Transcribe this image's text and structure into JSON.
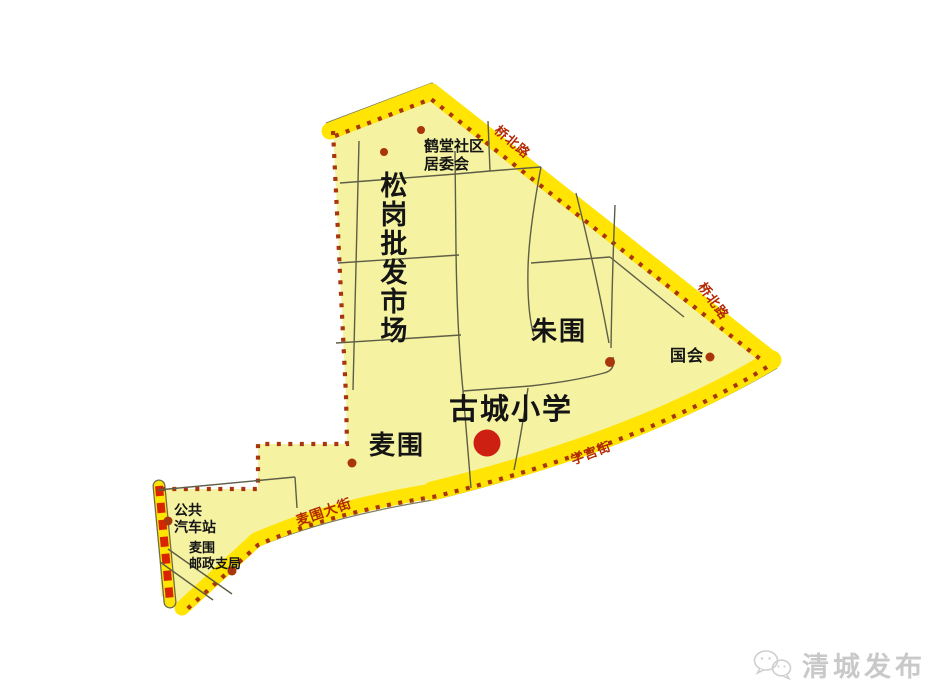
{
  "map": {
    "area_labels": {
      "songgang_market": "松岗批发市场",
      "zhuwei": "朱围",
      "maiwei": "麦围"
    },
    "poi_labels": {
      "hetang_committee": "鹤堂社区\n居委会",
      "guohui": "国会",
      "gucheng_school": "古城小学",
      "bus_station": "公共\n汽车站",
      "maiwei_post_office": "麦围\n邮政支局"
    },
    "road_labels": {
      "qiaobei_road_top": "桥北路",
      "qiaobei_road_right": "桥北路",
      "xuegong_street": "学宫街",
      "maiwei_street": "麦围大街"
    },
    "colors": {
      "region_fill": "#F5F2A2",
      "boundary_road_yellow": "#FFE404",
      "boundary_dot_red": "#A8350C",
      "highway_dash_red": "#D92400",
      "school_dot_red": "#CD1F12",
      "road_label_red": "#B32800"
    }
  },
  "watermark": {
    "text": "清城发布",
    "icon": "wechat-icon"
  }
}
